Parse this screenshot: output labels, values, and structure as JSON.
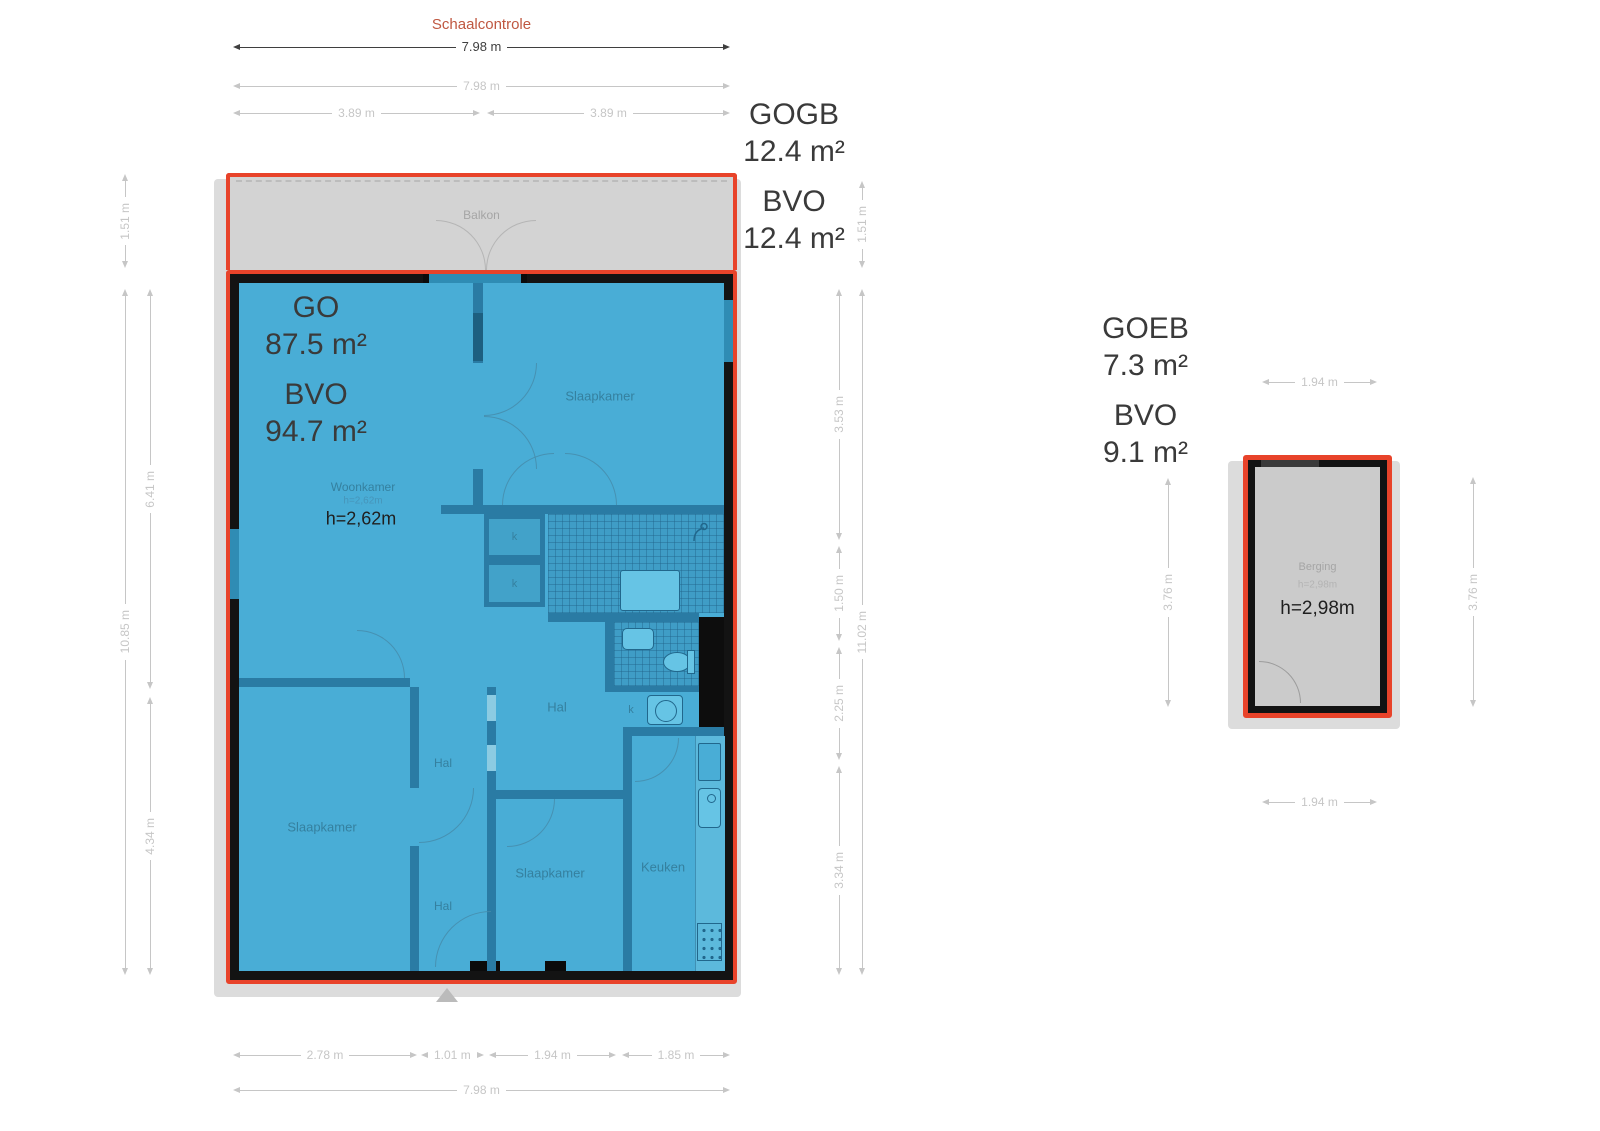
{
  "palette": {
    "red": "#e8432a",
    "blue": "#49add6",
    "wall": "#2a7ba4",
    "black": "#131313",
    "gray": "#d3d3d3",
    "sgray": "#cbcbcb",
    "dim": "#c6c6c6",
    "scale": "#bf5740",
    "label": "#3a3a3a",
    "room": "#35809f"
  },
  "scale_check": {
    "title": "Schaalcontrole",
    "value": "7.98 m"
  },
  "main_unit": {
    "areas": {
      "gogb": {
        "label": "GOGB",
        "value": "12.4 m²"
      },
      "bvo_balcony": {
        "label": "BVO",
        "value": "12.4 m²"
      },
      "go": {
        "label": "GO",
        "value": "87.5 m²"
      },
      "bvo": {
        "label": "BVO",
        "value": "94.7 m²"
      }
    },
    "rooms": {
      "balkon": "Balkon",
      "slaapkamer_top": "Slaapkamer",
      "woonkamer": "Woonkamer",
      "woonkamer_height_small": "h=2,62m",
      "woonkamer_height": "h=2,62m",
      "hal_main": "Hal",
      "hal_mid": "Hal",
      "hal_bottom": "Hal",
      "slaapkamer_left": "Slaapkamer",
      "slaapkamer_mid": "Slaapkamer",
      "keuken": "Keuken",
      "closet_1": "k",
      "closet_2": "k",
      "closet_3": "k",
      "closet_4": "k"
    },
    "dims": {
      "top_full": "7.98 m",
      "top_left": "3.89 m",
      "top_right": "3.89 m",
      "left_balcony": "1.51 m",
      "left_total": "10.85 m",
      "left_upper": "6.41 m",
      "left_lower": "4.34 m",
      "right_balcony": "1.51 m",
      "right_total": "11.02 m",
      "right_seg1": "3.53 m",
      "right_seg2": "1.50 m",
      "right_seg3": "2.25 m",
      "right_seg4": "3.34 m",
      "bottom_seg1": "2.78 m",
      "bottom_seg2": "1.01 m",
      "bottom_seg3": "1.94 m",
      "bottom_seg4": "1.85 m",
      "bottom_full": "7.98 m"
    }
  },
  "storage_unit": {
    "areas": {
      "goeb": {
        "label": "GOEB",
        "value": "7.3 m²"
      },
      "bvo": {
        "label": "BVO",
        "value": "9.1 m²"
      }
    },
    "rooms": {
      "berging": "Berging",
      "berging_height_small": "h=2,98m",
      "berging_height": "h=2,98m"
    },
    "dims": {
      "top": "1.94 m",
      "bottom": "1.94 m",
      "left": "3.76 m",
      "right": "3.76 m"
    }
  }
}
